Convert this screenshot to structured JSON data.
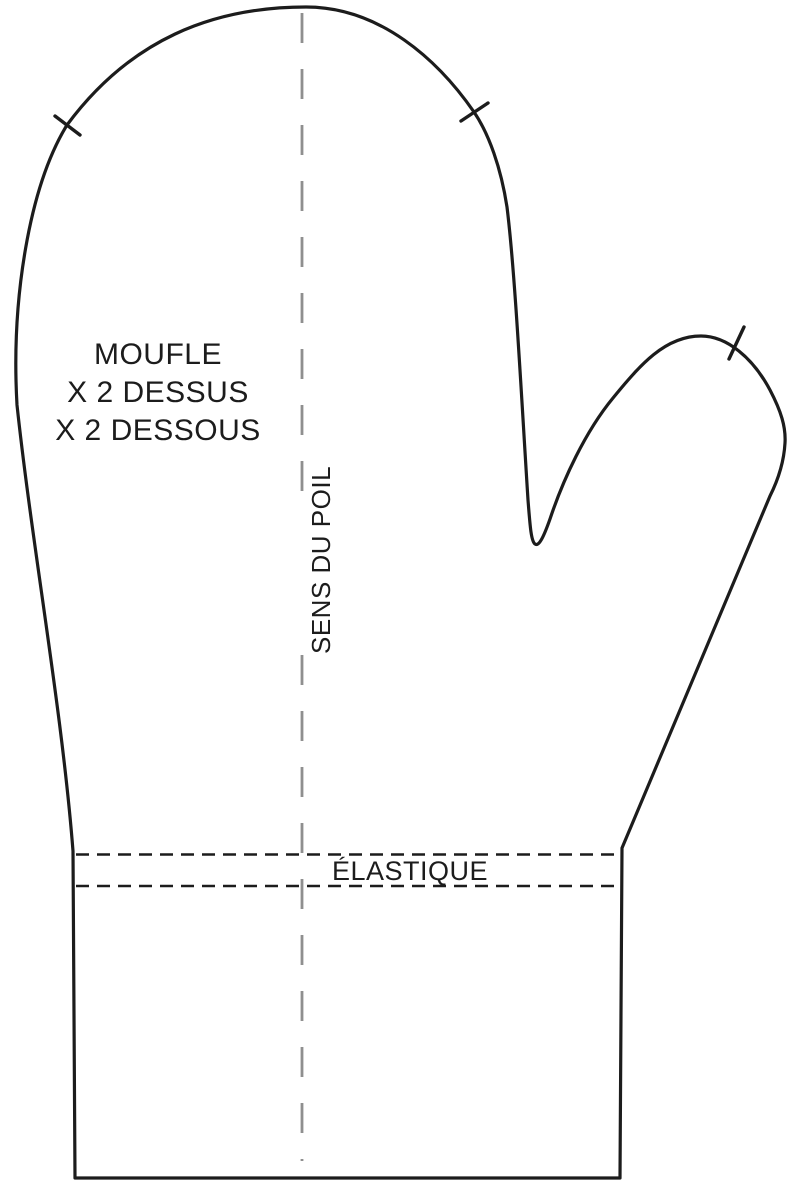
{
  "pattern": {
    "piece_label": {
      "name": "MOUFLE",
      "cut_top": "X 2 DESSUS",
      "cut_bottom": "X 2 DESSOUS"
    },
    "grainline_label": "SENS DU POIL",
    "elastic_label": "ÉLASTIQUE",
    "notch_count": 3,
    "colors": {
      "outline": "#1c1c1c",
      "grainline": "#8f8f8f",
      "elastic_dash": "#1c1c1c",
      "text": "#1c1c1c",
      "background": "#ffffff"
    }
  }
}
